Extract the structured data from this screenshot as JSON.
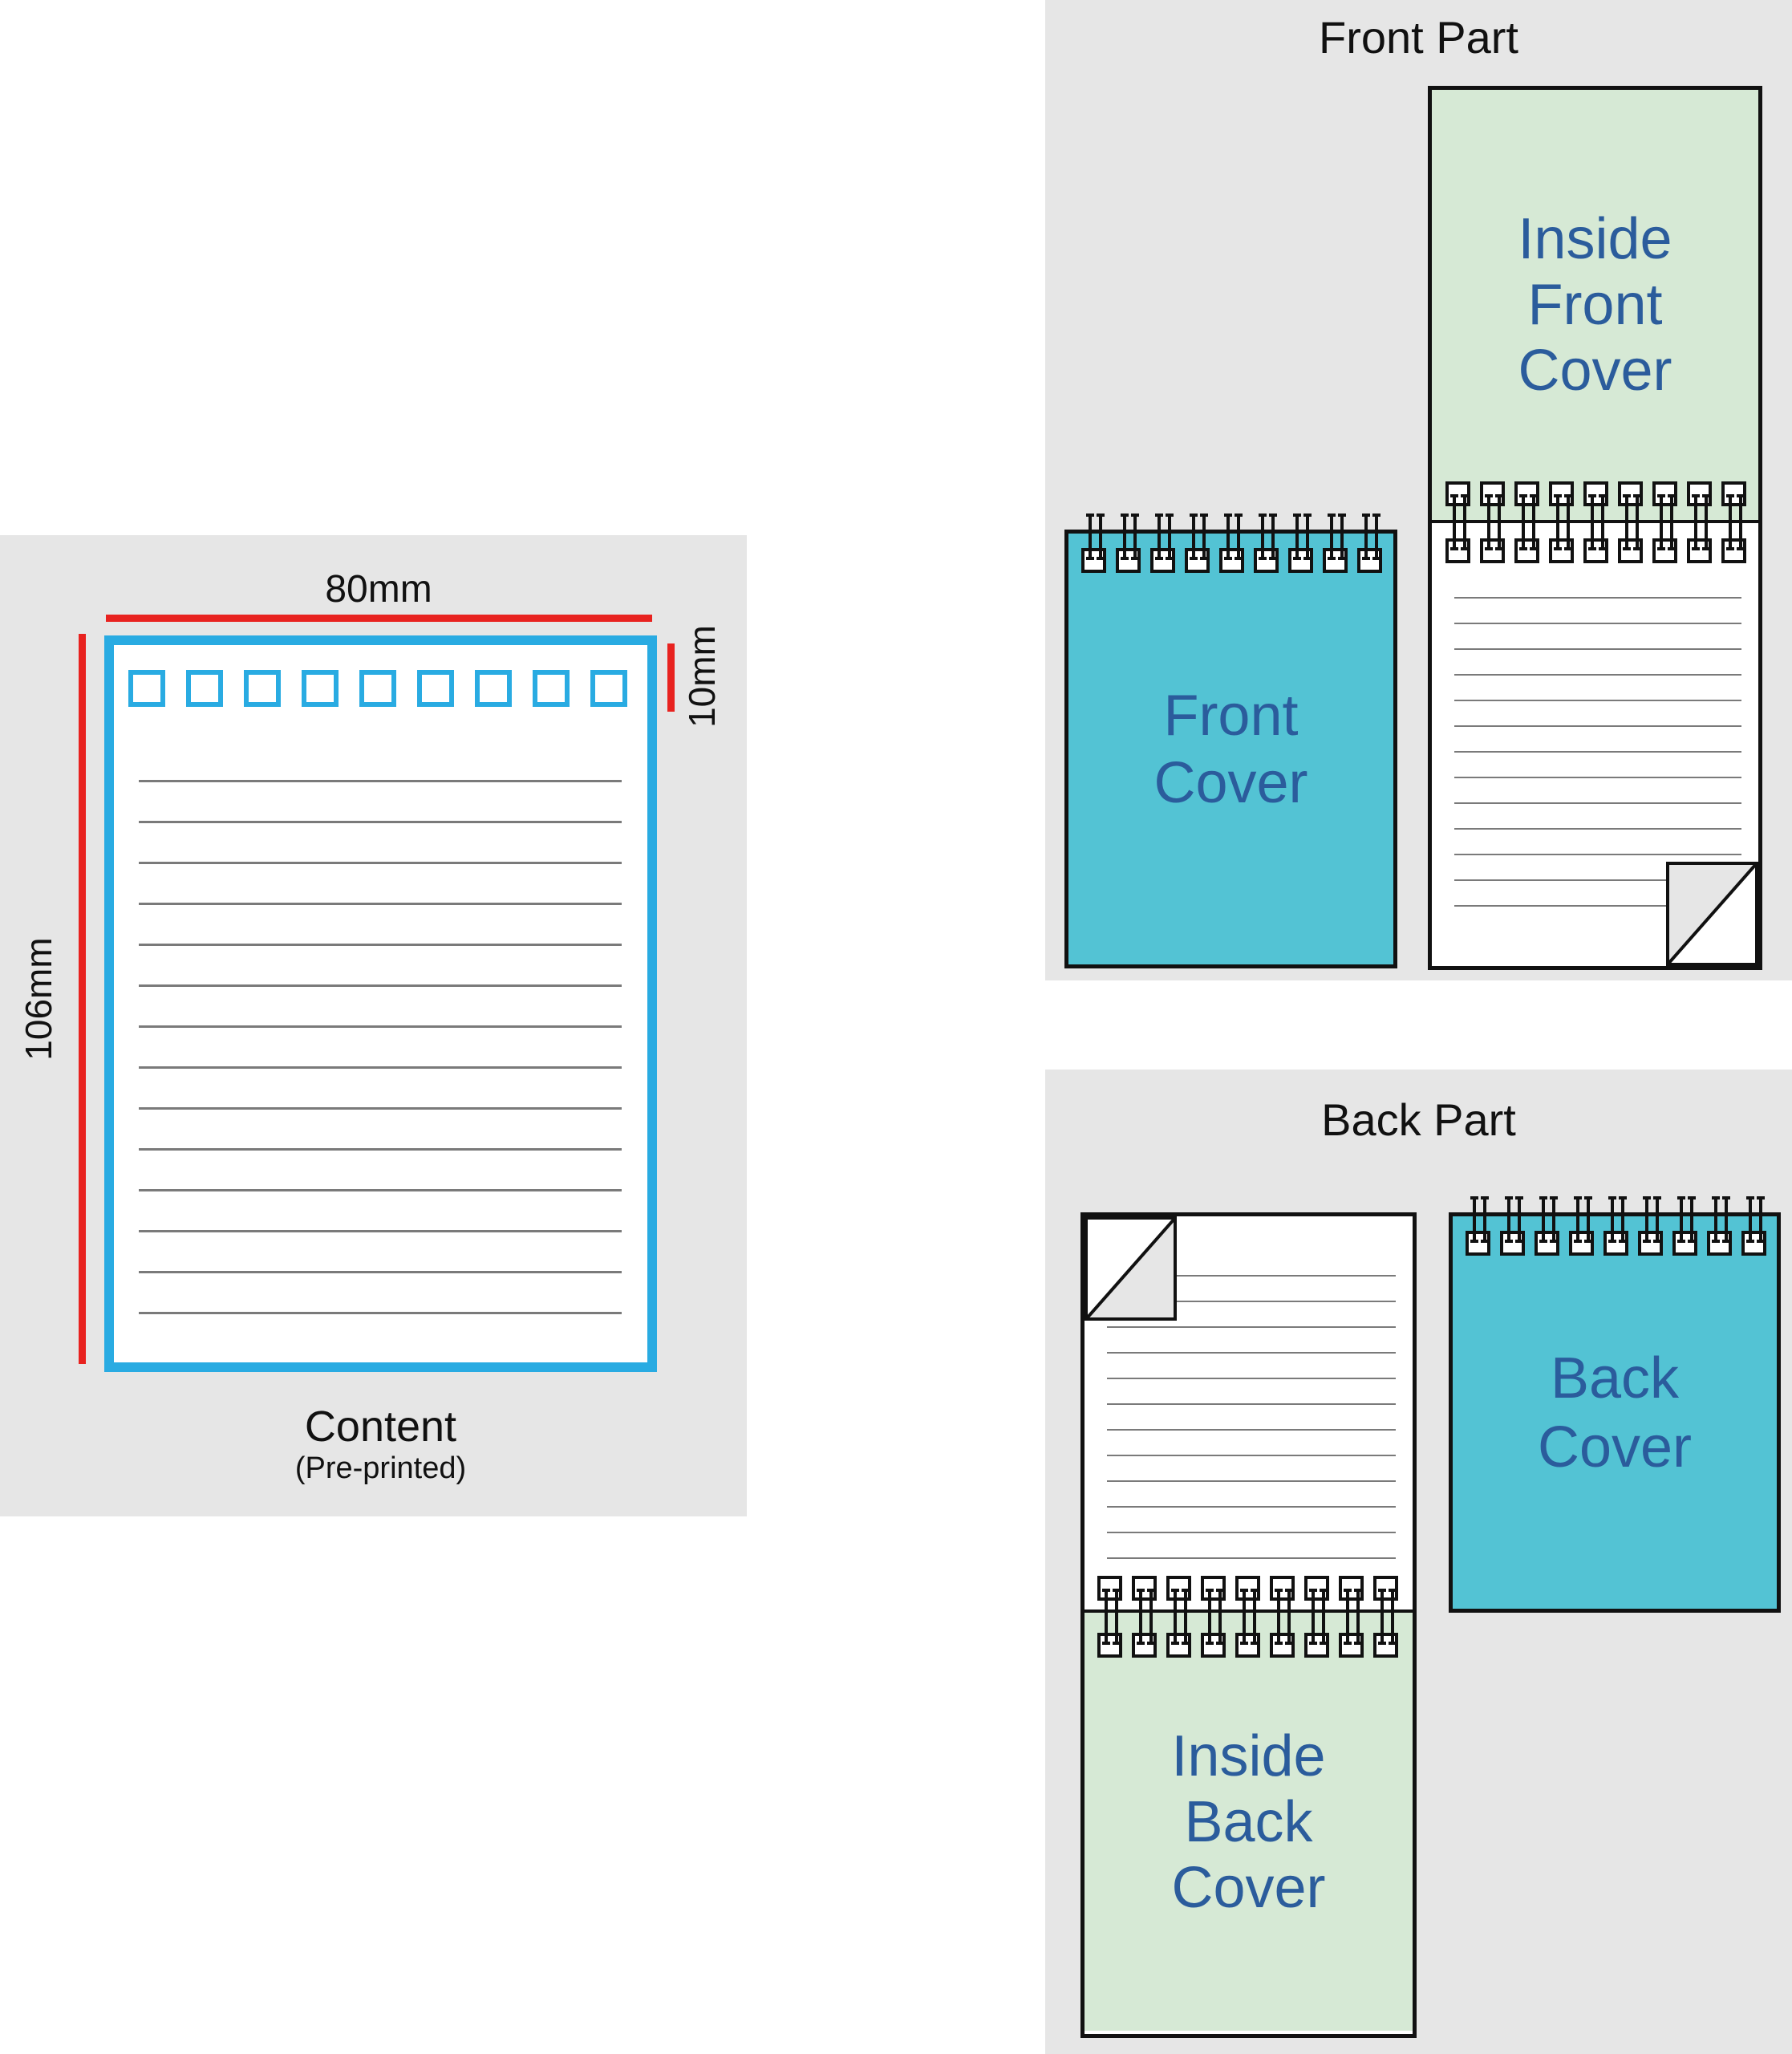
{
  "colors": {
    "panel-bg": "#e6e6e6",
    "teal": "#53c3d4",
    "pale-green": "#d6e9d5",
    "label-blue": "#2b5c9c",
    "red": "#e8221f",
    "cyan": "#29abe2",
    "rule-gray": "#7a7a7a",
    "fold-gray": "#e6e6e6",
    "ink": "#111111"
  },
  "left_panel": {
    "width_label": "80mm",
    "height_label": "106mm",
    "top_margin_label": "10mm",
    "caption": "Content",
    "caption_note": "(Pre-printed)",
    "hole_count": 9,
    "rule_count": 14
  },
  "front_part": {
    "title": "Front Part",
    "front_cover": {
      "lines": [
        "Front",
        "Cover"
      ],
      "binding_holes": 9
    },
    "inside_front_cover": {
      "lines": [
        "Inside",
        "Front",
        "Cover"
      ],
      "binding_holes": 9
    },
    "page_rule_count": 13
  },
  "back_part": {
    "title": "Back Part",
    "back_cover": {
      "lines": [
        "Back",
        "Cover"
      ],
      "binding_holes": 9
    },
    "inside_back_cover": {
      "lines": [
        "Inside",
        "Back",
        "Cover"
      ],
      "binding_holes": 9
    },
    "page_rule_count": 12
  }
}
